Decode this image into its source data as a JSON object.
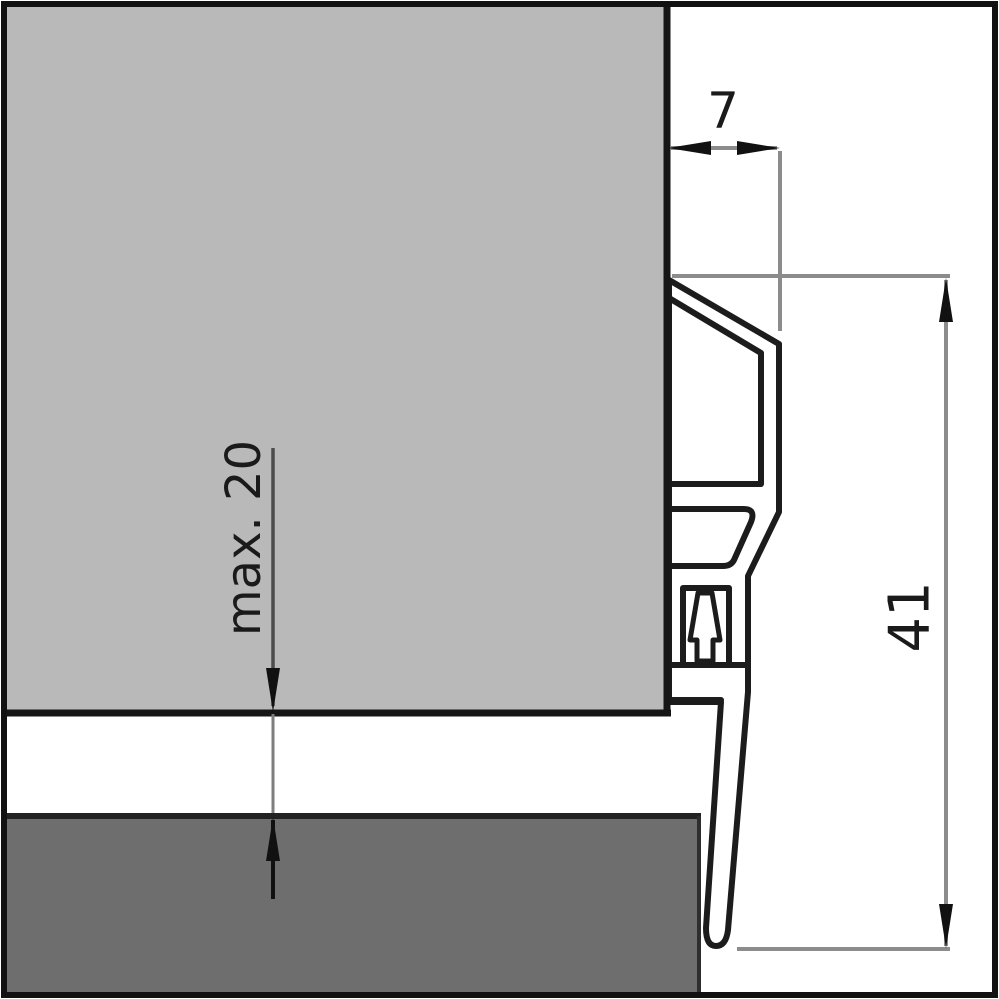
{
  "diagram": {
    "kind": "door-bottom-seal cross-section",
    "labels": {
      "dim_width": "7",
      "dim_height": "41",
      "dim_gap": "max. 20"
    },
    "colors": {
      "door_fill": "#b9b9b9",
      "floor_fill": "#6e6e6e",
      "profile_fill": "#ffffff",
      "outline": "#1c1c1c",
      "dim_line": "#8c8c8c",
      "arrow": "#111111",
      "frame": "#111111",
      "background": "#ffffff"
    }
  }
}
